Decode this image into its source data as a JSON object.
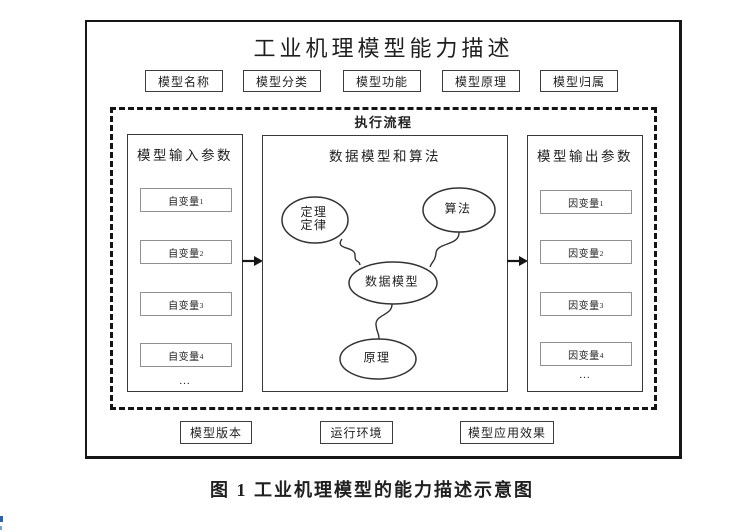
{
  "colors": {
    "line": "#161616",
    "panel_border": "#3a3a3a",
    "inner_border": "#8f8f8f",
    "text": "#1f1f1f",
    "background": "#ffffff",
    "edge_artifact_top": "#2b62ae",
    "edge_artifact_bottom": "#7aa0cf"
  },
  "figure": {
    "title": "工业机理模型能力描述",
    "attributes": [
      "模型名称",
      "模型分类",
      "模型功能",
      "模型原理",
      "模型归属"
    ],
    "process": {
      "label": "执行流程",
      "input_panel": {
        "title": "模型输入参数",
        "items": [
          {
            "base": "自变量",
            "index": "1"
          },
          {
            "base": "自变量",
            "index": "2"
          },
          {
            "base": "自变量",
            "index": "3"
          },
          {
            "base": "自变量",
            "index": "4"
          }
        ],
        "more": "..."
      },
      "model_panel": {
        "title": "数据模型和算法",
        "theorem_line1": "定理",
        "theorem_line2": "定律",
        "algorithm": "算法",
        "data_model": "数据模型",
        "principle": "原理"
      },
      "output_panel": {
        "title": "模型输出参数",
        "items": [
          {
            "base": "因变量",
            "index": "1"
          },
          {
            "base": "因变量",
            "index": "2"
          },
          {
            "base": "因变量",
            "index": "3"
          },
          {
            "base": "因变量",
            "index": "4"
          }
        ],
        "more": "..."
      }
    },
    "footer_boxes": [
      "模型版本",
      "运行环境",
      "模型应用效果"
    ],
    "caption": "图 1 工业机理模型的能力描述示意图"
  }
}
